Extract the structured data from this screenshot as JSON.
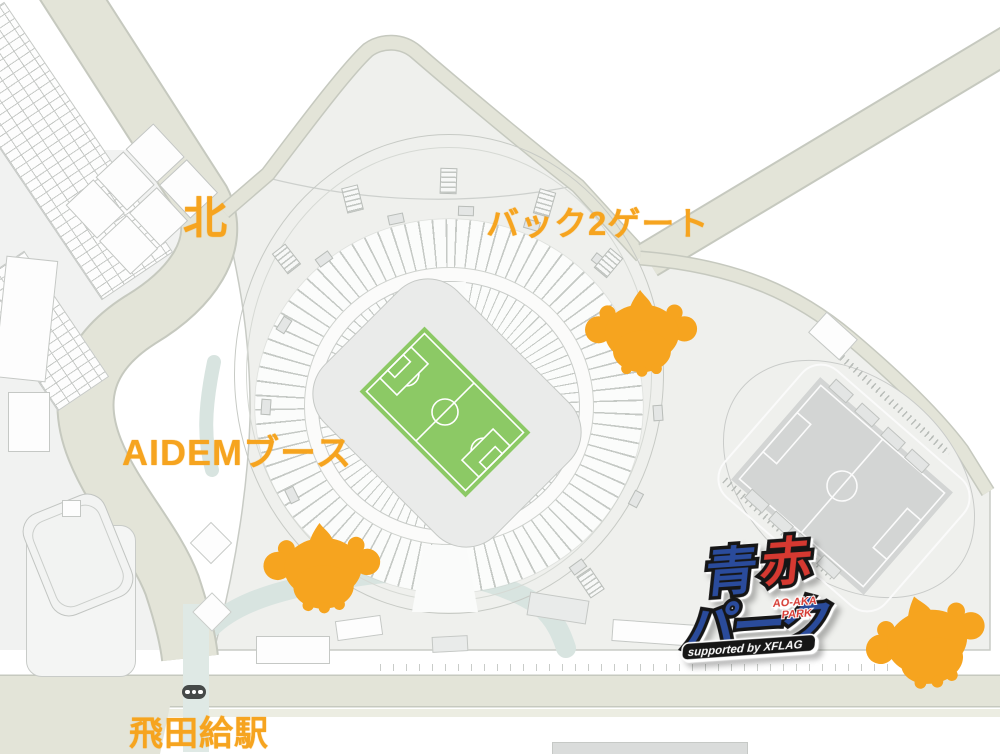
{
  "map": {
    "labels": {
      "north": "北",
      "back2_gate": "バック2ゲート",
      "aidem_booth": "AIDEMブース",
      "station": "飛田給駅"
    },
    "logo": {
      "kanji_blue": "青",
      "kanji_red": "赤",
      "katakana": "パーク",
      "subtitle_line1": "AO-AKA",
      "subtitle_line2": "PARK",
      "supported_by": "supported by XFLAG"
    },
    "markers": [
      {
        "id": "back2-gate-marker",
        "icon": "mascot-silhouette-icon"
      },
      {
        "id": "aidem-booth-marker",
        "icon": "mascot-silhouette-icon"
      },
      {
        "id": "aoaka-park-marker",
        "icon": "mascot-silhouette-icon"
      }
    ],
    "icons": {
      "station_signal": "traffic-light-icon"
    },
    "colors": {
      "accent_orange": "#F6A41F",
      "logo_blue": "#2A4B9B",
      "logo_red": "#D53931",
      "logo_outline": "#161616",
      "pitch_green": "#8CC965",
      "sub_pitch_gray": "#D3D5D4",
      "road_beige": "#E3E4D8",
      "grounds_gray": "#EFF0ED",
      "walkway_teal": "#D8E4E0"
    }
  }
}
